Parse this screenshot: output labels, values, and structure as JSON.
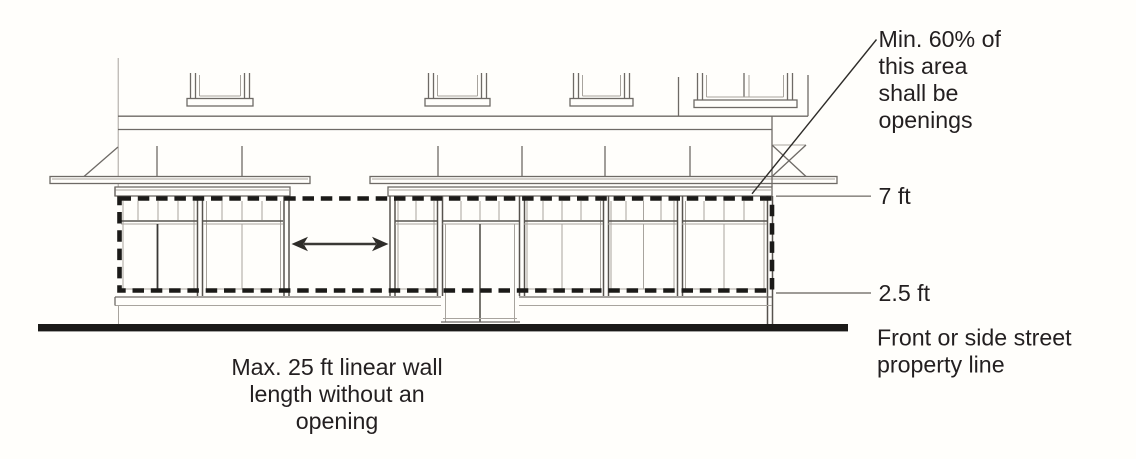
{
  "annotations": {
    "min_openings": [
      "Min. 60% of",
      "this area",
      "shall be",
      "openings"
    ],
    "top_height": "7 ft",
    "bottom_height": "2.5 ft",
    "property_line": [
      "Front or side street",
      "property line"
    ],
    "max_wall": [
      "Max. 25 ft linear wall",
      "length without an",
      "opening"
    ]
  },
  "colors": {
    "background": "#fffefb",
    "line_dark": "#2e2c29",
    "line_mid": "#6e6a66",
    "line_light": "#a8a49e",
    "dashed_outline": "#1b1a18",
    "street_line": "#1b1a18",
    "text": "#231f20"
  }
}
